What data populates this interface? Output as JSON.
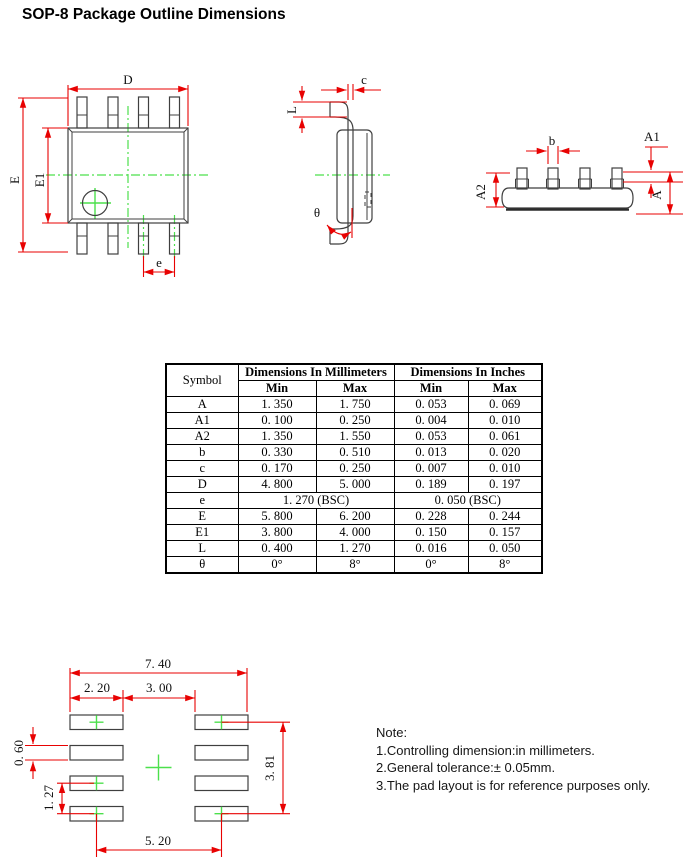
{
  "title": "SOP-8 Package Outline Dimensions",
  "colors": {
    "dimension_line": "#e80202",
    "centerline": "#4ce04c",
    "outline": "#3f3f3f"
  },
  "drawings": {
    "top_view_labels": {
      "D": "D",
      "E": "E",
      "E1": "E1",
      "e": "e"
    },
    "side_view_labels": {
      "c": "c",
      "L": "L",
      "theta": "θ"
    },
    "end_view_labels": {
      "b": "b",
      "A": "A",
      "A1": "A1",
      "A2": "A2"
    }
  },
  "table": {
    "col_symbol": "Symbol",
    "col_mm": "Dimensions In Millimeters",
    "col_in": "Dimensions In Inches",
    "min": "Min",
    "max": "Max",
    "rows": [
      {
        "symbol": "A",
        "mm_min": "1. 350",
        "mm_max": "1. 750",
        "in_min": "0. 053",
        "in_max": "0. 069"
      },
      {
        "symbol": "A1",
        "mm_min": "0. 100",
        "mm_max": "0. 250",
        "in_min": "0. 004",
        "in_max": "0. 010"
      },
      {
        "symbol": "A2",
        "mm_min": "1. 350",
        "mm_max": "1. 550",
        "in_min": "0. 053",
        "in_max": "0. 061"
      },
      {
        "symbol": "b",
        "mm_min": "0. 330",
        "mm_max": "0. 510",
        "in_min": "0. 013",
        "in_max": "0. 020"
      },
      {
        "symbol": "c",
        "mm_min": "0. 170",
        "mm_max": "0. 250",
        "in_min": "0. 007",
        "in_max": "0. 010"
      },
      {
        "symbol": "D",
        "mm_min": "4. 800",
        "mm_max": "5. 000",
        "in_min": "0. 189",
        "in_max": "0. 197"
      },
      {
        "symbol": "e",
        "mm_span": "1. 270 (BSC)",
        "in_span": "0. 050 (BSC)"
      },
      {
        "symbol": "E",
        "mm_min": "5. 800",
        "mm_max": "6. 200",
        "in_min": "0. 228",
        "in_max": "0. 244"
      },
      {
        "symbol": "E1",
        "mm_min": "3. 800",
        "mm_max": "4. 000",
        "in_min": "0. 150",
        "in_max": "0. 157"
      },
      {
        "symbol": "L",
        "mm_min": "0. 400",
        "mm_max": "1. 270",
        "in_min": "0. 016",
        "in_max": "0. 050"
      },
      {
        "symbol": "θ",
        "mm_min": "0°",
        "mm_max": "8°",
        "in_min": "0°",
        "in_max": "8°"
      }
    ]
  },
  "pad_layout_dims": {
    "width_total": "7. 40",
    "pad_width": "2. 20",
    "gap": "3. 00",
    "pad_height": "0. 60",
    "pitch": "1. 27",
    "height_span": "3. 81",
    "bottom_span": "5. 20"
  },
  "notes": {
    "heading": "Note:",
    "items": [
      "1.Controlling dimension:in millimeters.",
      "2.General tolerance:± 0.05mm.",
      "3.The pad layout is for reference purposes only."
    ]
  }
}
